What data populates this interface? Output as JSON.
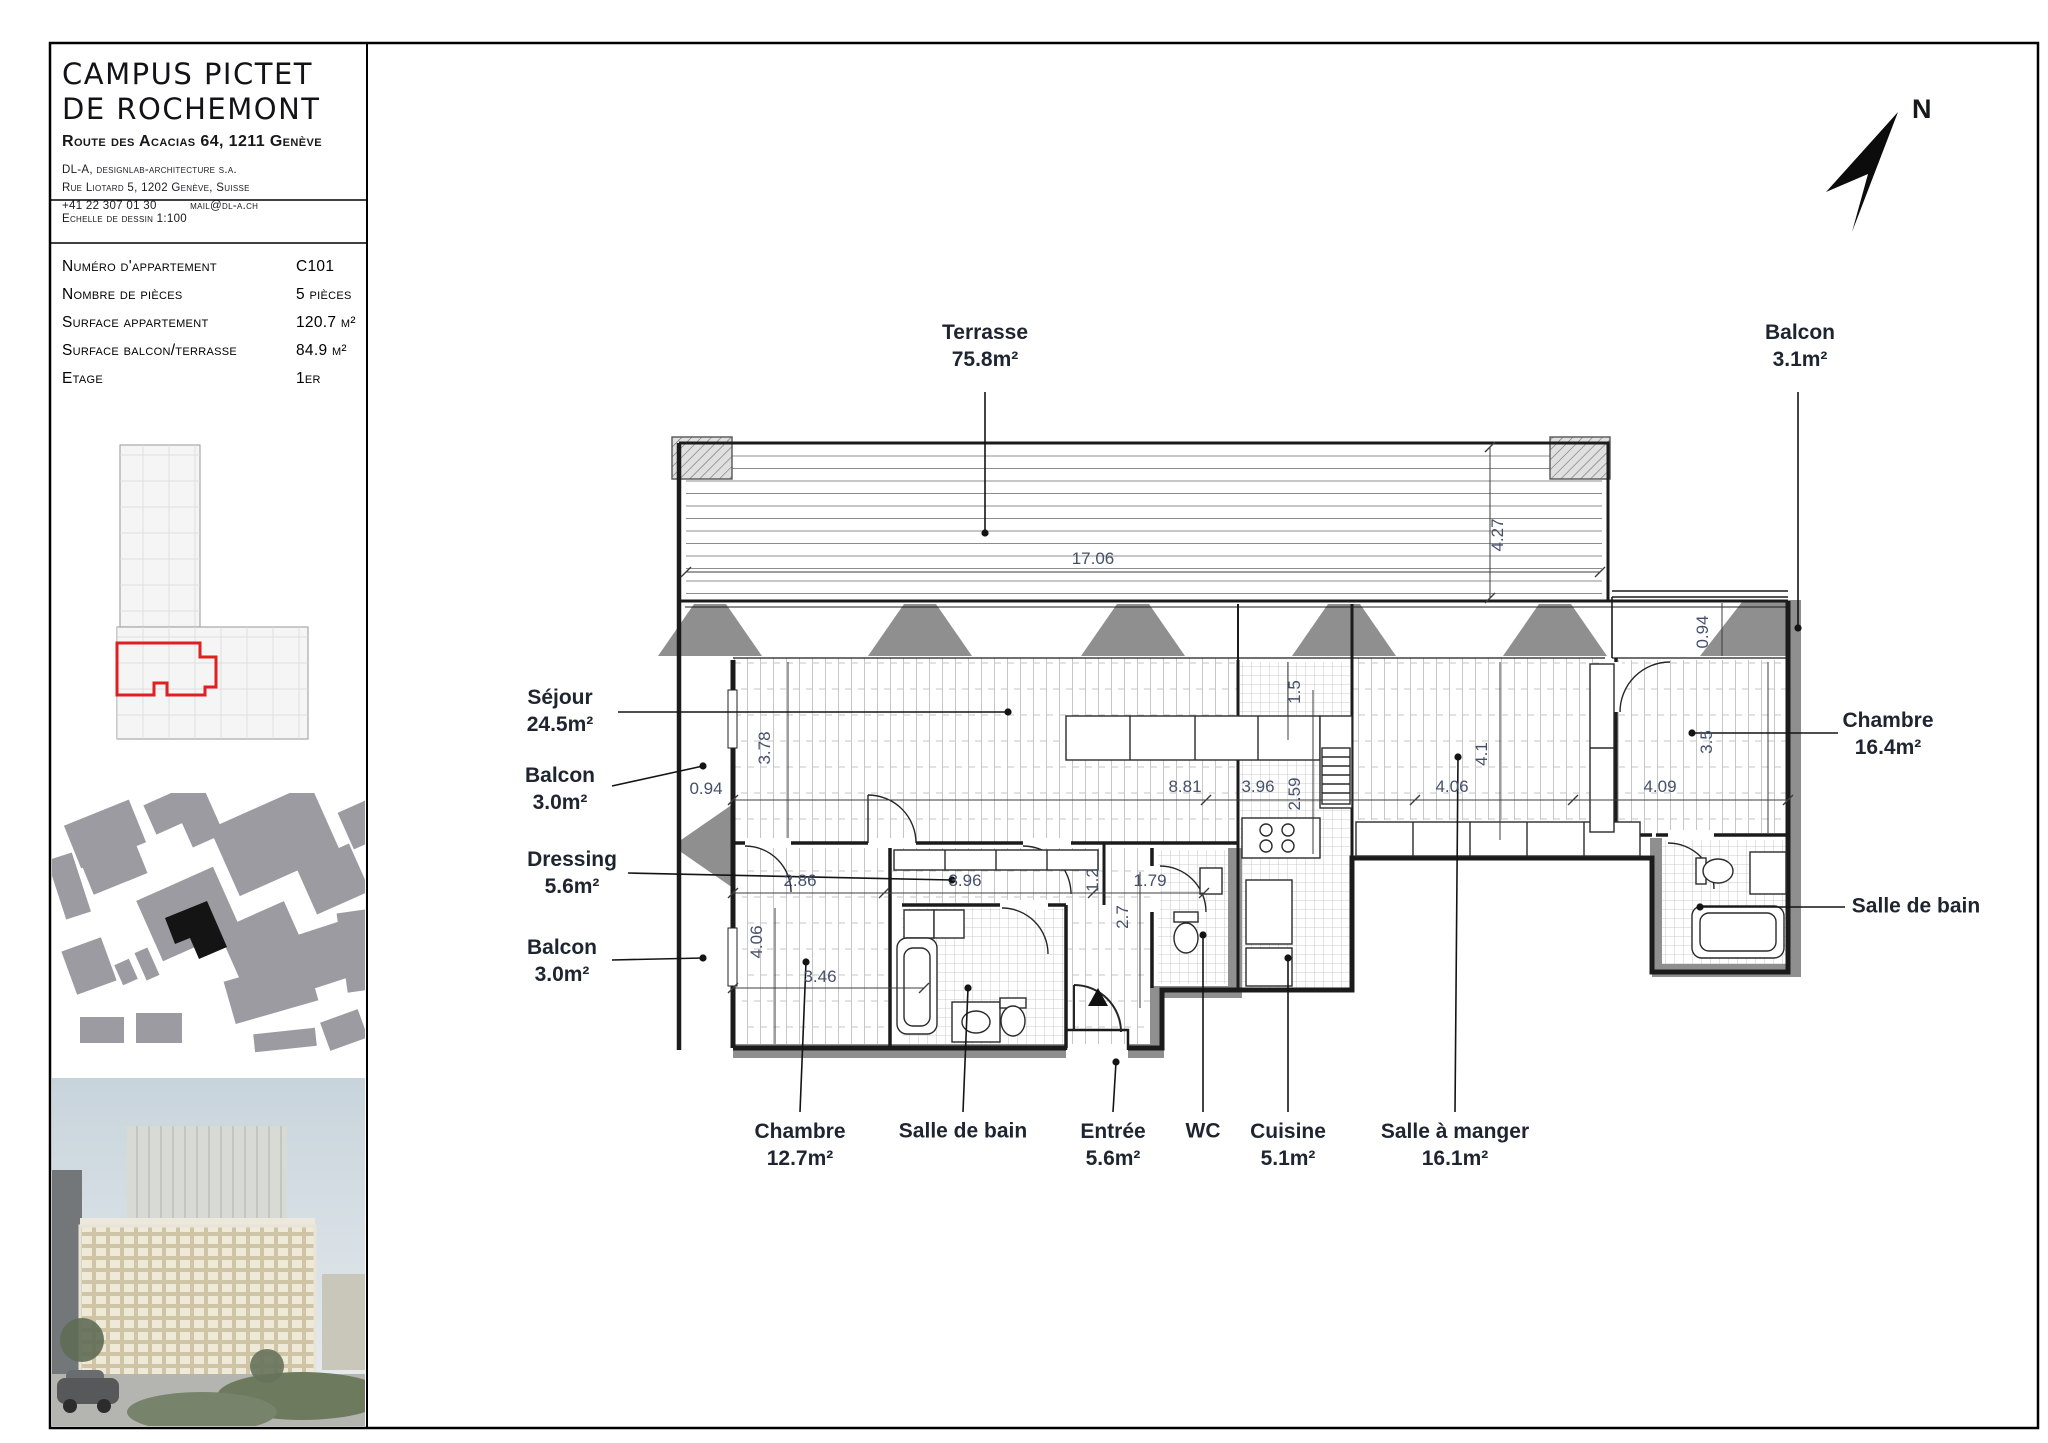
{
  "colors": {
    "accent_red": "#e02020",
    "wall_gray": "#8f8f8f",
    "dim_text": "#44506a",
    "site_building_black": "#141414"
  },
  "titleblock": {
    "title1": "CAMPUS PICTET",
    "title2": "DE ROCHEMONT",
    "address": "Route des Acacias 64, 1211 Genève",
    "firm1": "DL-A, designlab-architecture s.a.",
    "firm2": "Rue Liotard 5, 1202 Genève, Suisse",
    "phone": "+41 22 307 01 30",
    "email": "mail@dl-a.ch",
    "scale": "Echelle de dessin 1:100",
    "rows": [
      {
        "label": "Numéro d'appartement",
        "value": "C101"
      },
      {
        "label": "Nombre de pièces",
        "value": "5 pièces"
      },
      {
        "label": "Surface appartement",
        "value": "120.7 m²"
      },
      {
        "label": "Surface balcon/terrasse",
        "value": "84.9 m²"
      },
      {
        "label": "Etage",
        "value": "1er"
      }
    ]
  },
  "plan": {
    "north": "N",
    "rooms": [
      {
        "name": "Terrasse",
        "area": "75.8m²"
      },
      {
        "name": "Balcon",
        "area": "3.1m²"
      },
      {
        "name": "Séjour",
        "area": "24.5m²"
      },
      {
        "name": "Balcon",
        "area": "3.0m²"
      },
      {
        "name": "Dressing",
        "area": "5.6m²"
      },
      {
        "name": "Balcon",
        "area": "3.0m²"
      },
      {
        "name": "Chambre",
        "area": "12.7m²"
      },
      {
        "name": "Salle de bain",
        "area": ""
      },
      {
        "name": "Entrée",
        "area": "5.6m²"
      },
      {
        "name": "WC",
        "area": ""
      },
      {
        "name": "Cuisine",
        "area": "5.1m²"
      },
      {
        "name": "Salle à manger",
        "area": "16.1m²"
      },
      {
        "name": "Chambre",
        "area": "16.4m²"
      },
      {
        "name": "Salle de bain",
        "area": ""
      }
    ],
    "dims": {
      "terrace_w": "17.06",
      "terrace_d": "4.27",
      "balcony_ne_d": "0.94",
      "sejour_d": "3.78",
      "balcony_w_w": "0.94",
      "sejour_w": "8.81",
      "kitchen_notch": "1.5",
      "kitchen_w": "3.96",
      "kitchen_d": "2.59",
      "dining_w": "4.06",
      "dining_d": "4.1",
      "chambre_e_w": "4.09",
      "chambre_e_d": "3.5",
      "chambre_sw_w": "2.86",
      "dressing_w": "3.96",
      "dressing_wall": "1.2",
      "entree_w": "1.79",
      "entree_d": "2.7",
      "chambre_sw_d": "4.06",
      "chambre_sw_w2": "3.46"
    }
  }
}
